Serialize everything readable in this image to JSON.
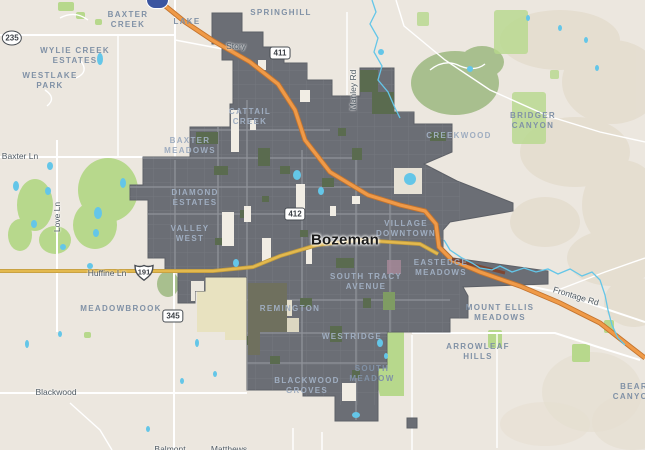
{
  "map": {
    "city_label": "Bozeman",
    "neighborhoods": [
      {
        "t": "BAXTER\nCREEK",
        "x": 128,
        "y": 20,
        "on": false
      },
      {
        "t": "LAKE",
        "x": 187,
        "y": 22,
        "on": false
      },
      {
        "t": "SPRINGHILL",
        "x": 281,
        "y": 13,
        "on": false
      },
      {
        "t": "WYLIE CREEK\nESTATES",
        "x": 75,
        "y": 56,
        "on": false
      },
      {
        "t": "WESTLAKE\nPARK",
        "x": 50,
        "y": 81,
        "on": false
      },
      {
        "t": "BRIDGER\nCANYON",
        "x": 533,
        "y": 121,
        "on": false
      },
      {
        "t": "CREEKWOOD",
        "x": 459,
        "y": 136,
        "on": true
      },
      {
        "t": "CATTAIL\nCREEK",
        "x": 250,
        "y": 117,
        "on": true
      },
      {
        "t": "BAXTER\nMEADOWS",
        "x": 190,
        "y": 146,
        "on": true
      },
      {
        "t": "DIAMOND\nESTATES",
        "x": 195,
        "y": 198,
        "on": true
      },
      {
        "t": "VALLEY\nWEST",
        "x": 190,
        "y": 234,
        "on": true
      },
      {
        "t": "VILLAGE\nDOWNTOWN",
        "x": 406,
        "y": 229,
        "on": true
      },
      {
        "t": "SOUTH TRACY\nAVENUE",
        "x": 366,
        "y": 282,
        "on": true
      },
      {
        "t": "EASTEDGE\nMEADOWS",
        "x": 441,
        "y": 268,
        "on": true
      },
      {
        "t": "MEADOWBROOK",
        "x": 121,
        "y": 309,
        "on": false
      },
      {
        "t": "REMINGTON",
        "x": 290,
        "y": 309,
        "on": true
      },
      {
        "t": "MOUNT ELLIS\nMEADOWS",
        "x": 500,
        "y": 313,
        "on": false
      },
      {
        "t": "WESTRIDGE",
        "x": 352,
        "y": 337,
        "on": true
      },
      {
        "t": "ARROWLEAF\nHILLS",
        "x": 478,
        "y": 352,
        "on": false
      },
      {
        "t": "SOUTH\nMEADOW",
        "x": 372,
        "y": 374,
        "on": false
      },
      {
        "t": "BLACKWOOD\nGROVES",
        "x": 307,
        "y": 386,
        "on": true
      },
      {
        "t": "BEAR\nCANYON",
        "x": 634,
        "y": 392,
        "on": false
      }
    ],
    "road_labels": [
      {
        "t": "Story",
        "x": 236,
        "y": 46,
        "r": 0
      },
      {
        "t": "Manley Rd",
        "x": 353,
        "y": 90,
        "r": -90
      },
      {
        "t": "Baxter Ln",
        "x": 20,
        "y": 156,
        "r": 0
      },
      {
        "t": "Love Ln",
        "x": 57,
        "y": 217,
        "r": -90
      },
      {
        "t": "Huffine Ln",
        "x": 107,
        "y": 273,
        "r": 0
      },
      {
        "t": "Frontage Rd",
        "x": 576,
        "y": 296,
        "r": 17
      },
      {
        "t": "Blackwood",
        "x": 56,
        "y": 392,
        "r": 0
      },
      {
        "t": "Balmont",
        "x": 170,
        "y": 449,
        "r": 0
      },
      {
        "t": "Matthews",
        "x": 229,
        "y": 449,
        "r": 0
      }
    ],
    "shields": [
      {
        "n": "235",
        "type": "oval",
        "x": 12,
        "y": 38
      },
      {
        "n": "411",
        "type": "rect",
        "x": 280,
        "y": 53
      },
      {
        "n": "412",
        "type": "rect",
        "x": 295,
        "y": 214
      },
      {
        "n": "345",
        "type": "rect",
        "x": 173,
        "y": 316
      },
      {
        "n": "191",
        "type": "us",
        "x": 144,
        "y": 272
      }
    ],
    "colors": {
      "land": "#ece7df",
      "overlay": "#6b6e75",
      "overlay_edge": "#5d6067",
      "overlay_street": "#7b7e85",
      "overlay_street_major": "#90939a",
      "overlay_park": "#5a6b4f",
      "building": "#f1ede4",
      "green_bright": "#b7d88c",
      "green_muted": "#a8bf8e",
      "khaki": "#e8e2c0",
      "olive": "#6f705e",
      "water": "#64c6e8",
      "gold": "#e3b94e",
      "gold_casing": "#c09a3e",
      "i90": "#ef9a48",
      "i90_casing": "#c4742e",
      "maroon": "#7e4631",
      "terrain": "#e3dbcc",
      "label": "#8091a6",
      "label_on": "#9fadc0",
      "road_label": "#4f5a63",
      "city_label": "#1a1a1a",
      "shield_border": "#474c52",
      "marker": "#3b55a0"
    }
  }
}
